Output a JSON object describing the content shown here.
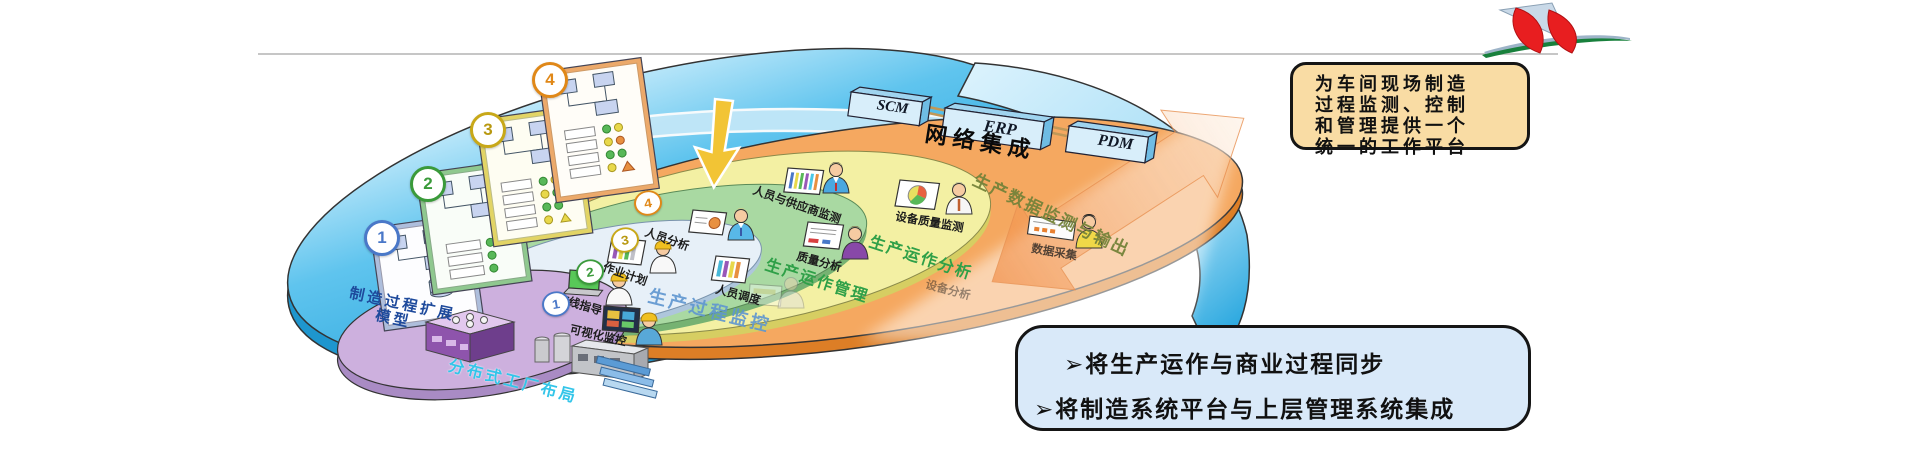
{
  "network": {
    "label": "网络集成"
  },
  "systems": [
    {
      "name": "SCM"
    },
    {
      "name": "ERP"
    },
    {
      "name": "PDM"
    }
  ],
  "model": {
    "line1": "制造过程扩展",
    "line2": "模型"
  },
  "layers": [
    {
      "badge": "4",
      "title": "生产数据监测与输出",
      "color": "#F5A860",
      "items": [
        "人员与供应商监测",
        "设备质量监测",
        "数据采集"
      ]
    },
    {
      "badge": "3",
      "title": "生产运作分析",
      "color": "#F3F0A3",
      "items": [
        "人员分析",
        "质量分析",
        "设备分析"
      ]
    },
    {
      "badge": "2",
      "title": "生产运作管理",
      "color": "#A9D9A2",
      "items": [
        "作业计划",
        "人员调度"
      ]
    },
    {
      "badge": "1",
      "title": "生产过程监控",
      "color": "#E7F0F8",
      "items": [
        "在线指导",
        "可视化监控"
      ]
    },
    {
      "badge": "",
      "title": "分布式工厂布局",
      "color": "#CDB0DE",
      "items": []
    }
  ],
  "cards": [
    {
      "number": "1"
    },
    {
      "number": "2"
    },
    {
      "number": "3"
    },
    {
      "number": "4"
    }
  ],
  "callout_platform": {
    "bg": "#F9DCA4",
    "lines": [
      "为车间现场制造",
      "过程监测、控制",
      "和管理提供一个",
      "统一的工作平台"
    ]
  },
  "callout_goals": {
    "bg": "#D9E9F9",
    "bullet": "➢",
    "items": [
      "将生产运作与商业过程同步",
      "将制造系统平台与上层管理系统集成"
    ]
  }
}
